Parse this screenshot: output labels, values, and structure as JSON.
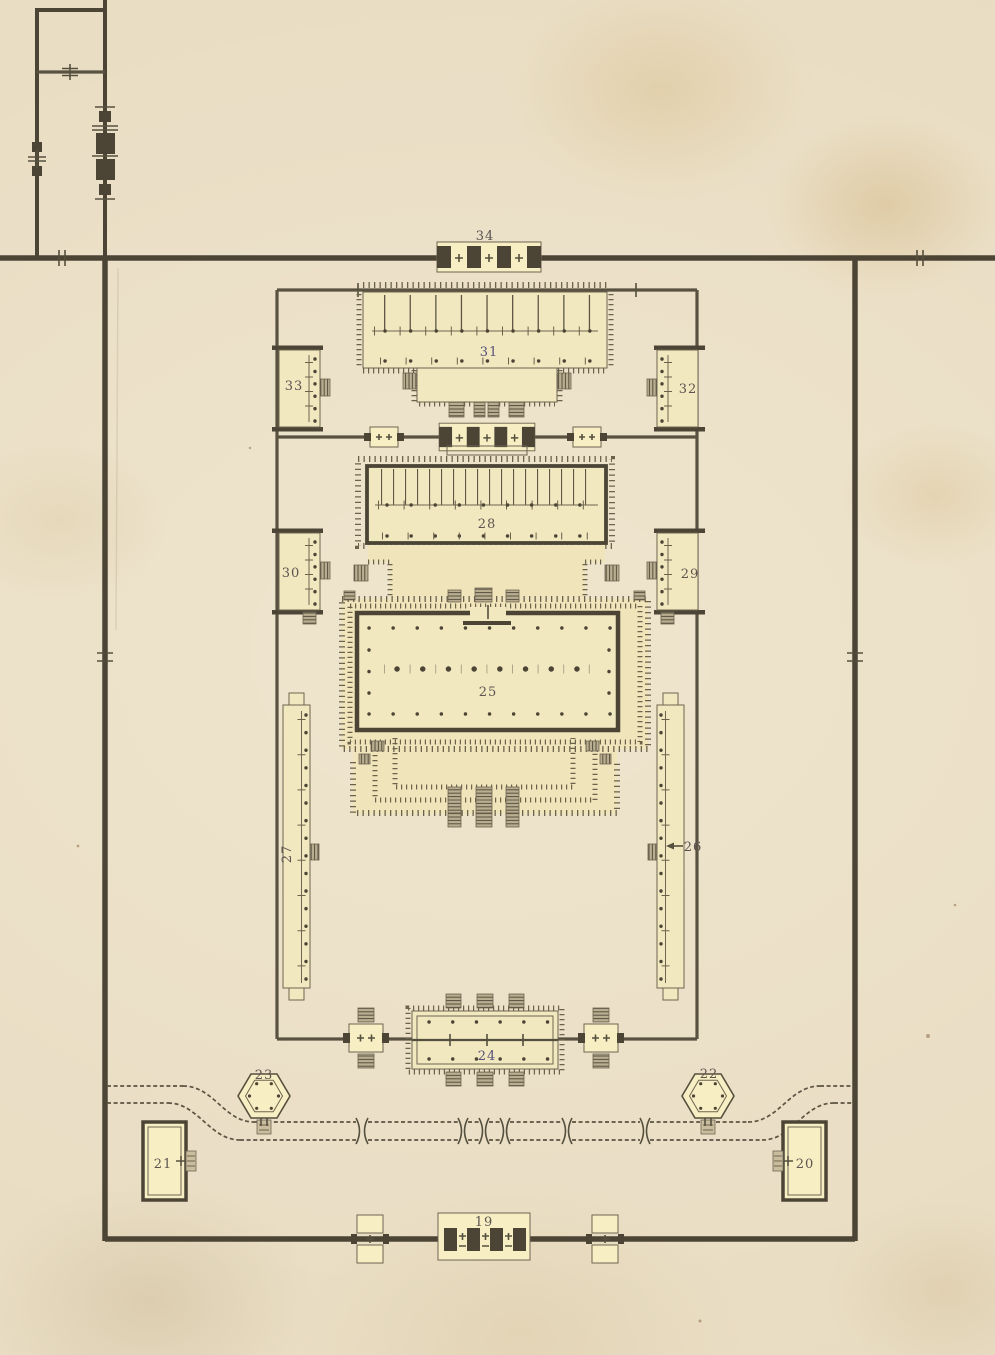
{
  "plan": {
    "labels": {
      "l19": "19",
      "l20": "20",
      "l21": "21",
      "l22": "22",
      "l23": "23",
      "l24": "24",
      "l25": "25",
      "l26": "26",
      "l27": "27",
      "l28": "28",
      "l29": "29",
      "l30": "30",
      "l31": "31",
      "l32": "32",
      "l33": "33",
      "l34": "34"
    },
    "palette": {
      "paper": "#e8dcc2",
      "wall_ink": "#4c4536",
      "line_ink": "#6b624c",
      "building_fill": "#f2e8c0",
      "building_bright": "#f7efc3",
      "terrace_fill": "#f0e5ba",
      "stair_gray": "#c9bd9e",
      "label_ink": "#5d5450",
      "label_violet": "#555178"
    }
  }
}
